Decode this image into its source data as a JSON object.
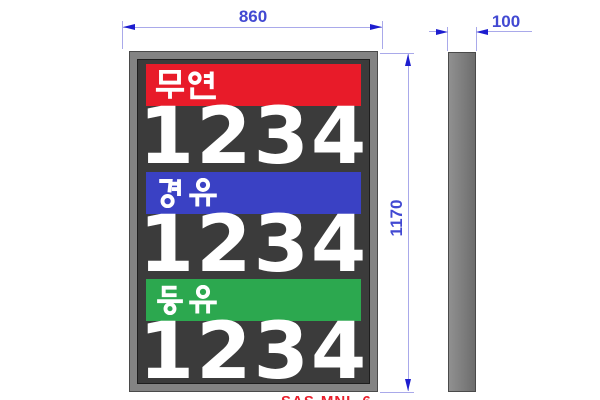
{
  "dimensions": {
    "front_width": "860",
    "front_height": "1170",
    "side_depth": "100"
  },
  "front_view": {
    "panel_color": "#3b3b3b",
    "frame_color": "#838383",
    "digit_color": "#ffffff",
    "rows": [
      {
        "fuel_name": "무연",
        "band_color": "#e81b29",
        "band_style": "background-color:#e81b29",
        "price_digits": "1234"
      },
      {
        "fuel_name": "경유",
        "band_color": "#3a41c4",
        "band_style": "background-color:#3a41c4",
        "price_digits": "1234"
      },
      {
        "fuel_name": "등유",
        "band_color": "#2ca84f",
        "band_style": "background-color:#2ca84f",
        "price_digits": "1234"
      }
    ]
  },
  "side_view": {
    "fill_color": "#7d7d7d"
  },
  "annotation": {
    "partial_label_clipped": "SAS-MNL-6",
    "label_color": "#e8212e"
  },
  "dim_style": {
    "line_color": "#a9a9ea",
    "arrow_color": "#1d1dcf",
    "text_color": "#4249d2"
  }
}
